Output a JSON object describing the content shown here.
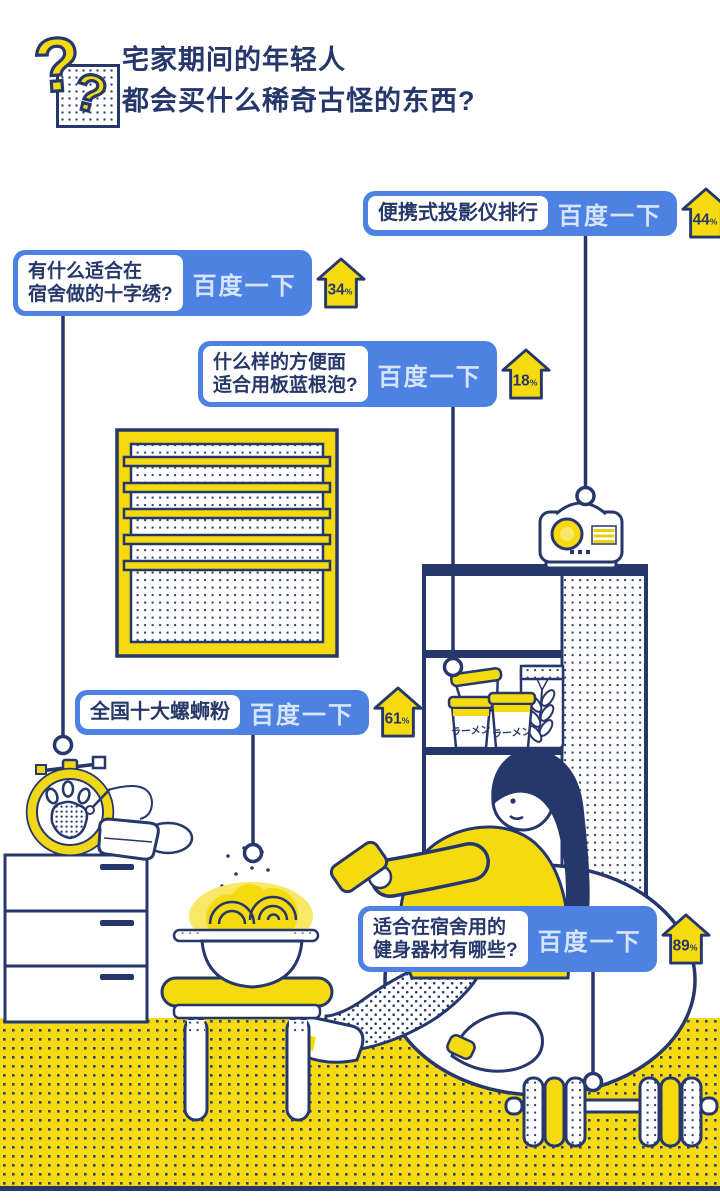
{
  "header": {
    "title_line1": "宅家期间的年轻人",
    "title_line2": "都会买什么稀奇古怪的东西?",
    "logo_glyph": "?"
  },
  "colors": {
    "accent_blue": "#4d82e2",
    "navy": "#26376b",
    "yellow": "#f6da10",
    "button_text": "#d7e5fa"
  },
  "callouts": [
    {
      "id": "projector",
      "query_lines": [
        "便携式投影仪排行"
      ],
      "button_label": "百度一下",
      "percent": "44"
    },
    {
      "id": "cross-stitch",
      "query_lines": [
        "有什么适合在",
        "宿舍做的十字绣?"
      ],
      "button_label": "百度一下",
      "percent": "34"
    },
    {
      "id": "instant-noodle",
      "query_lines": [
        "什么样的方便面",
        "适合用板蓝根泡?"
      ],
      "button_label": "百度一下",
      "percent": "18"
    },
    {
      "id": "luosifen",
      "query_lines": [
        "全国十大螺蛳粉"
      ],
      "button_label": "百度一下",
      "percent": "61"
    },
    {
      "id": "fitness",
      "query_lines": [
        "适合在宿舍用的",
        "健身器材有哪些?"
      ],
      "button_label": "百度一下",
      "percent": "89"
    }
  ],
  "illustration": {
    "ramen_cup_label": "ラーメン",
    "percent_suffix": "%"
  }
}
